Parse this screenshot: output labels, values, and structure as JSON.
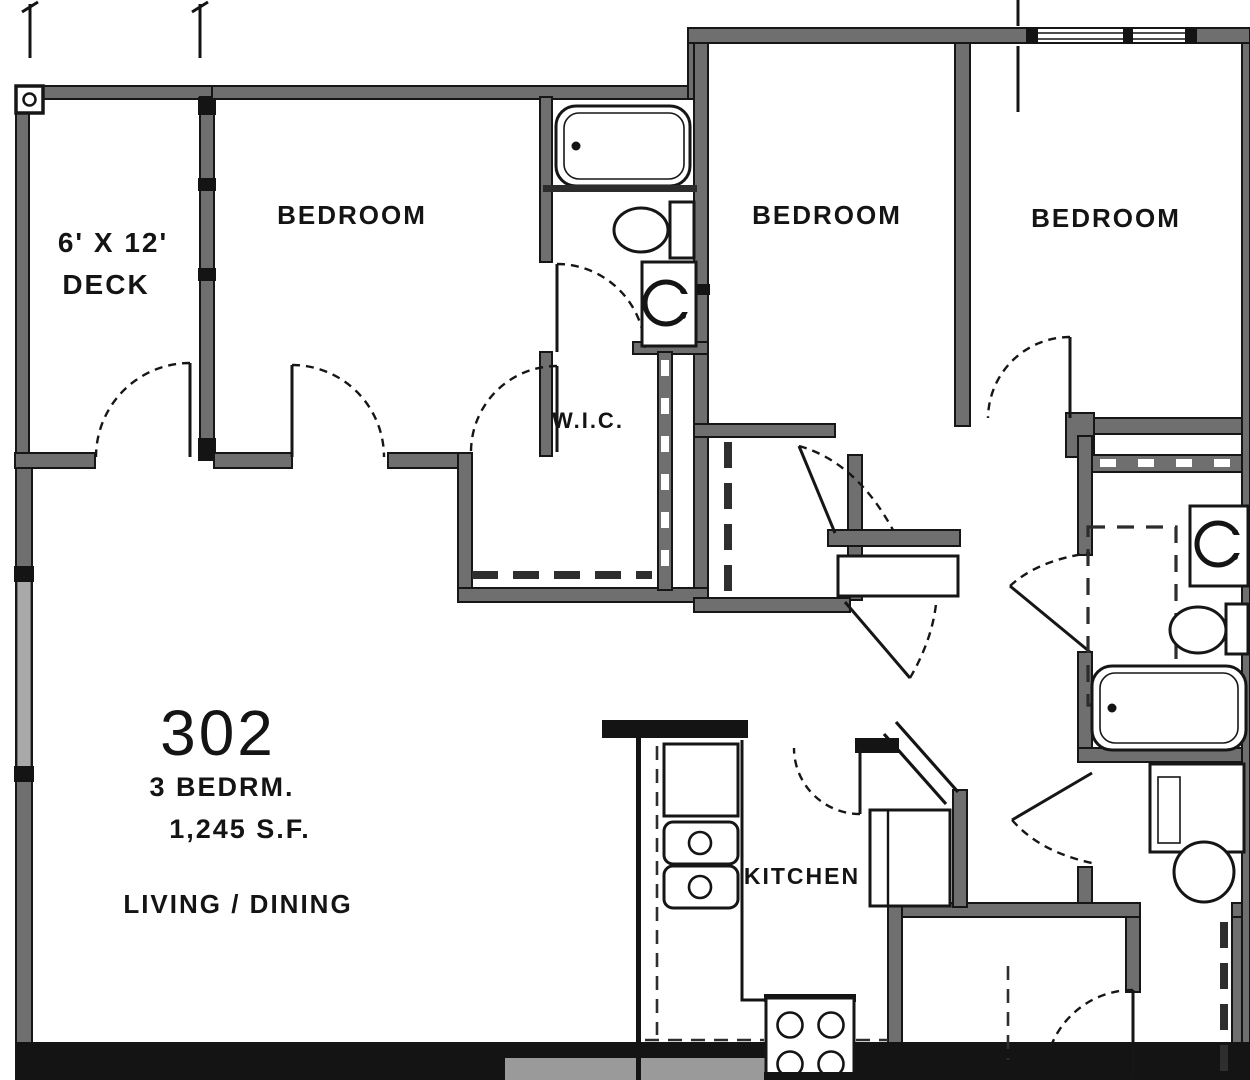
{
  "plan": {
    "unit_number": "302",
    "unit_type": "3 BEDRM.",
    "unit_area": "1,245 S.F.",
    "rooms": {
      "deck_dim": "6' X 12'",
      "deck": "DECK",
      "bedroom_1": "BEDROOM",
      "bedroom_2": "BEDROOM",
      "bedroom_3": "BEDROOM",
      "wic": "W.I.C.",
      "living_dining": "LIVING / DINING",
      "kitchen": "KITCHEN"
    },
    "colors": {
      "wall_gray": "#6f6f6f",
      "line_black": "#141414",
      "window_gray": "#9a9a9a",
      "background": "#ffffff"
    }
  }
}
